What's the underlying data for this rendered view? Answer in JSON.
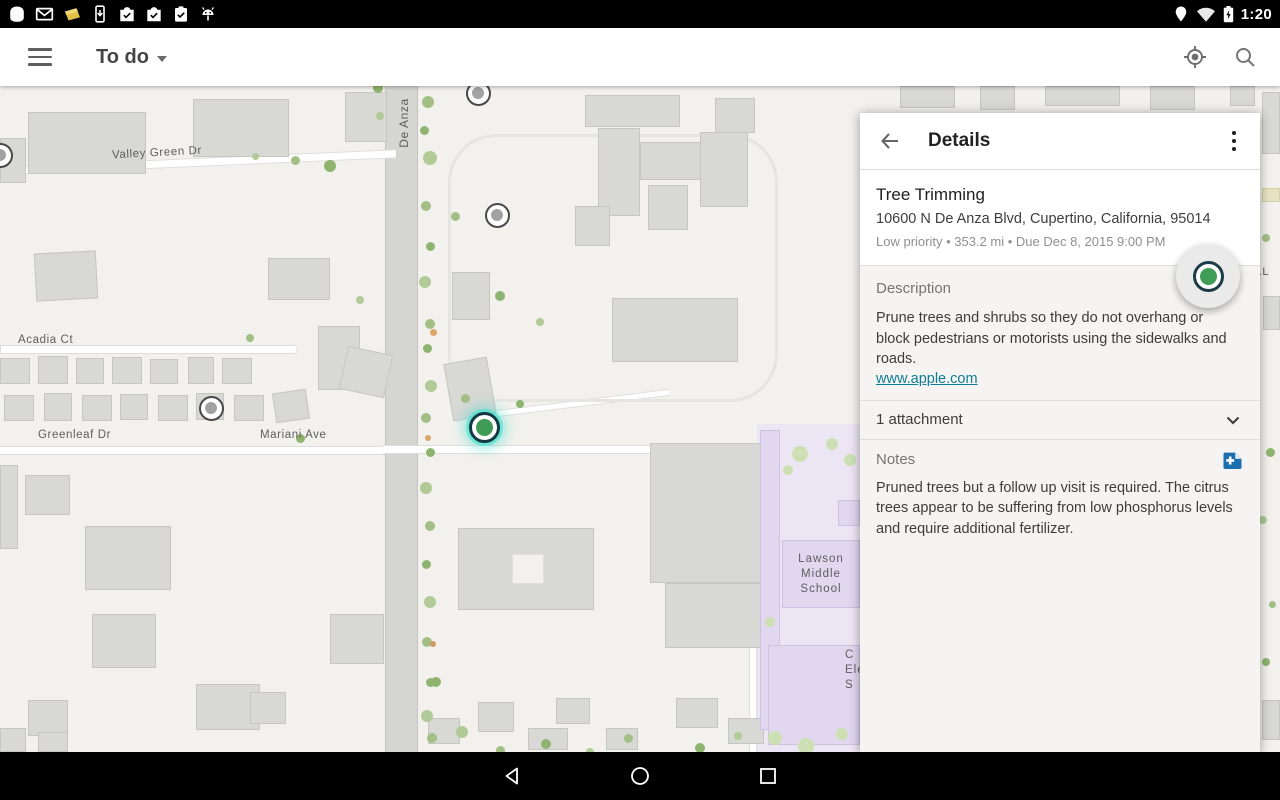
{
  "status_bar": {
    "time": "1:20",
    "left_icons": [
      "notification-blob-icon",
      "gmail-icon",
      "note-yellow-icon",
      "device-download-icon",
      "playstore-check-icon",
      "playstore-check-icon",
      "clipboard-check-icon",
      "android-robot-icon"
    ],
    "right_icons": [
      "location-pin-icon",
      "wifi-icon",
      "battery-charging-icon"
    ]
  },
  "toolbar": {
    "menu_icon": "hamburger-icon",
    "title": "To do",
    "dropdown_icon": "caret-down-icon",
    "actions": [
      "gps-locate-icon",
      "search-icon"
    ]
  },
  "map": {
    "labels": [
      {
        "text": "Valley Green Dr"
      },
      {
        "text": "De Anza"
      },
      {
        "text": "Acadia Ct"
      },
      {
        "text": "Greenleaf Dr"
      },
      {
        "text": "Mariani Ave"
      },
      {
        "text": "Lawson\nMiddle\nSchool"
      },
      {
        "text": "C\nEle\nS"
      },
      {
        "text": "e.L"
      }
    ],
    "markers": {
      "unselected_count": 4,
      "selected_count": 1,
      "selected_color": "#3e9c57",
      "glow_color": "#3de0cd"
    }
  },
  "panel": {
    "header": {
      "back_icon": "arrow-left-icon",
      "title": "Details",
      "overflow_icon": "kebab-menu-icon"
    },
    "task": {
      "title": "Tree Trimming",
      "address": "10600 N De Anza Blvd, Cupertino, California, 95014",
      "meta": "Low priority  •  353.2 mi  •  Due Dec 8, 2015 9:00 PM"
    },
    "description": {
      "label": "Description",
      "body": "Prune trees and shrubs so they do not overhang or block pedestrians or motorists using the sidewalks and roads.",
      "link": "www.apple.com"
    },
    "attachments": {
      "label": "1 attachment",
      "chevron_icon": "chevron-down-icon"
    },
    "notes": {
      "label": "Notes",
      "add_icon": "add-note-icon",
      "body": "Pruned trees but a follow up visit is required. The citrus trees appear to be suffering from low phosphorus levels and require additional fertilizer."
    }
  },
  "nav_bar": {
    "icons": [
      "back",
      "home",
      "recents"
    ]
  },
  "colors": {
    "accent_link": "#0e7d92",
    "marker_green": "#3e9c57",
    "note_icon_blue": "#1b6fae",
    "school_zone_purple": "#ece5f4",
    "map_background": "#f2f1ed"
  }
}
